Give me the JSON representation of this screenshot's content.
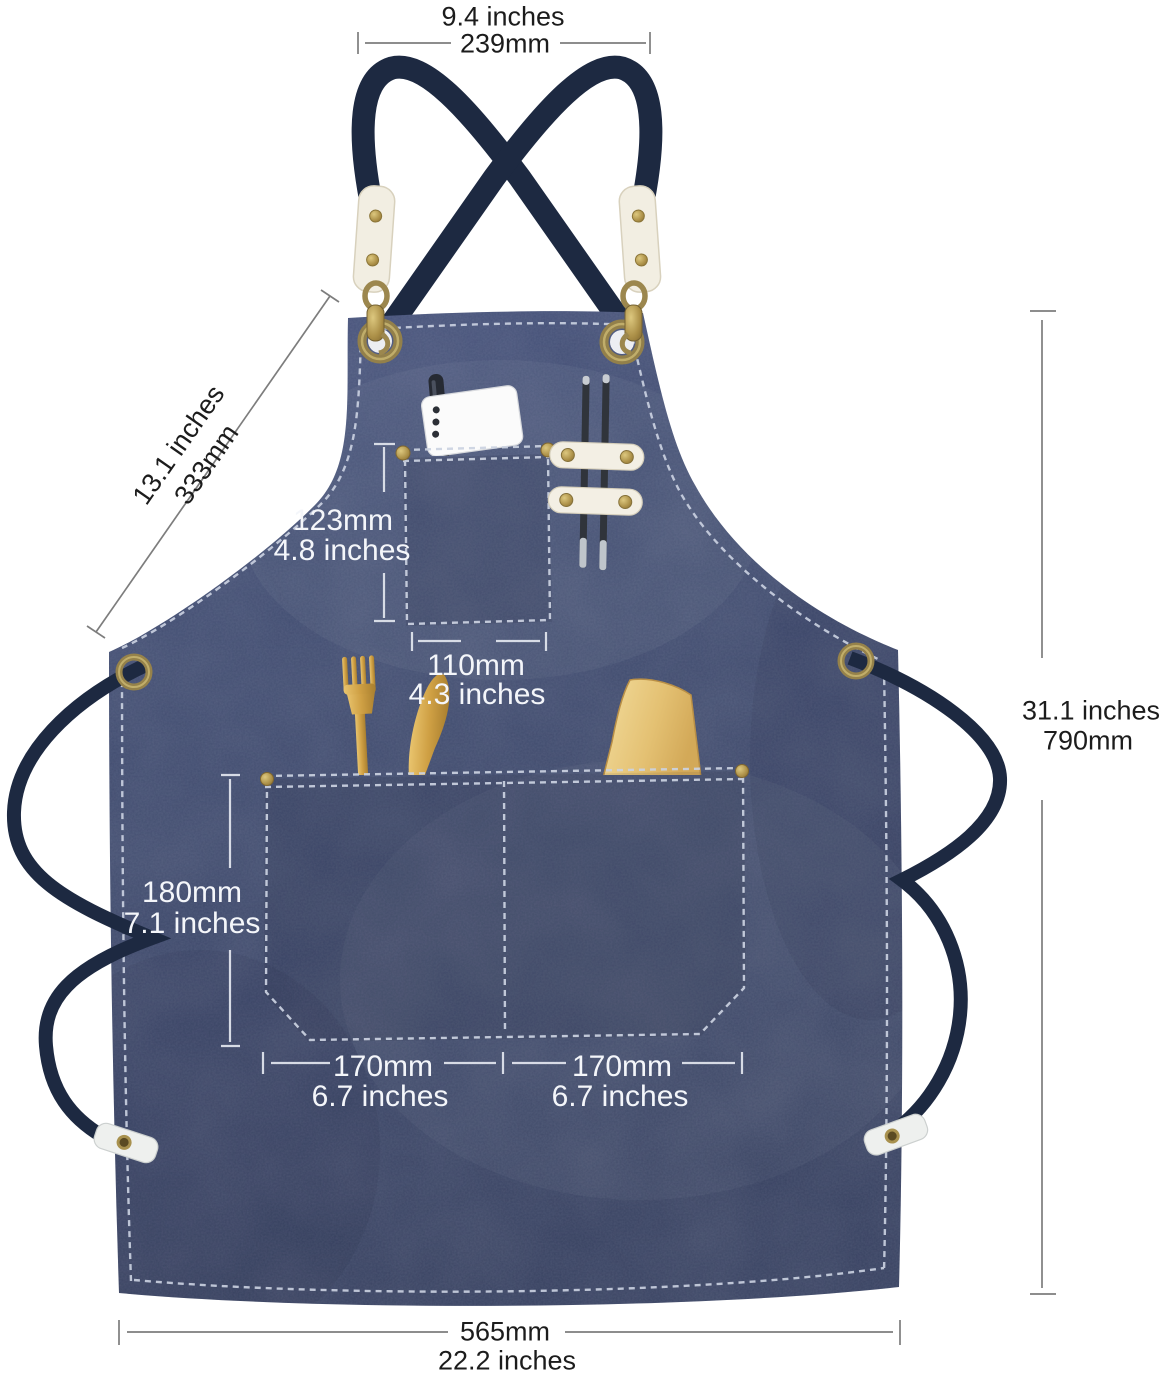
{
  "product_diagram": {
    "description": "Denim cross-back apron with dimension annotations",
    "dimensions": {
      "strap_top_width": {
        "inches": "9.4 inches",
        "mm": "239mm"
      },
      "armhole_diagonal": {
        "inches": "13.1 inches",
        "mm": "333mm"
      },
      "chest_pocket_height": {
        "mm": "123mm",
        "inches": "4.8 inches"
      },
      "chest_pocket_width": {
        "mm": "110mm",
        "inches": "4.3 inches"
      },
      "waist_pocket_height": {
        "mm": "180mm",
        "inches": "7.1 inches"
      },
      "waist_pocket_left_width": {
        "mm": "170mm",
        "inches": "6.7 inches"
      },
      "waist_pocket_right_width": {
        "mm": "170mm",
        "inches": "6.7 inches"
      },
      "apron_length": {
        "inches": "31.1 inches",
        "mm": "790mm"
      },
      "bottom_width": {
        "mm": "565mm",
        "inches": "22.2 inches"
      }
    },
    "colors": {
      "background": "#ffffff",
      "denim": "#3d4869",
      "strap": "#1d2941",
      "stitching": "#ccd3e2",
      "brass": "#a8914e",
      "leather": "#f2eee2",
      "gold_cutlery": "#d2a44c",
      "wood": "#e7cb82",
      "annotation_dark": "#1c1c1c",
      "annotation_light": "#f4f6fa"
    }
  }
}
